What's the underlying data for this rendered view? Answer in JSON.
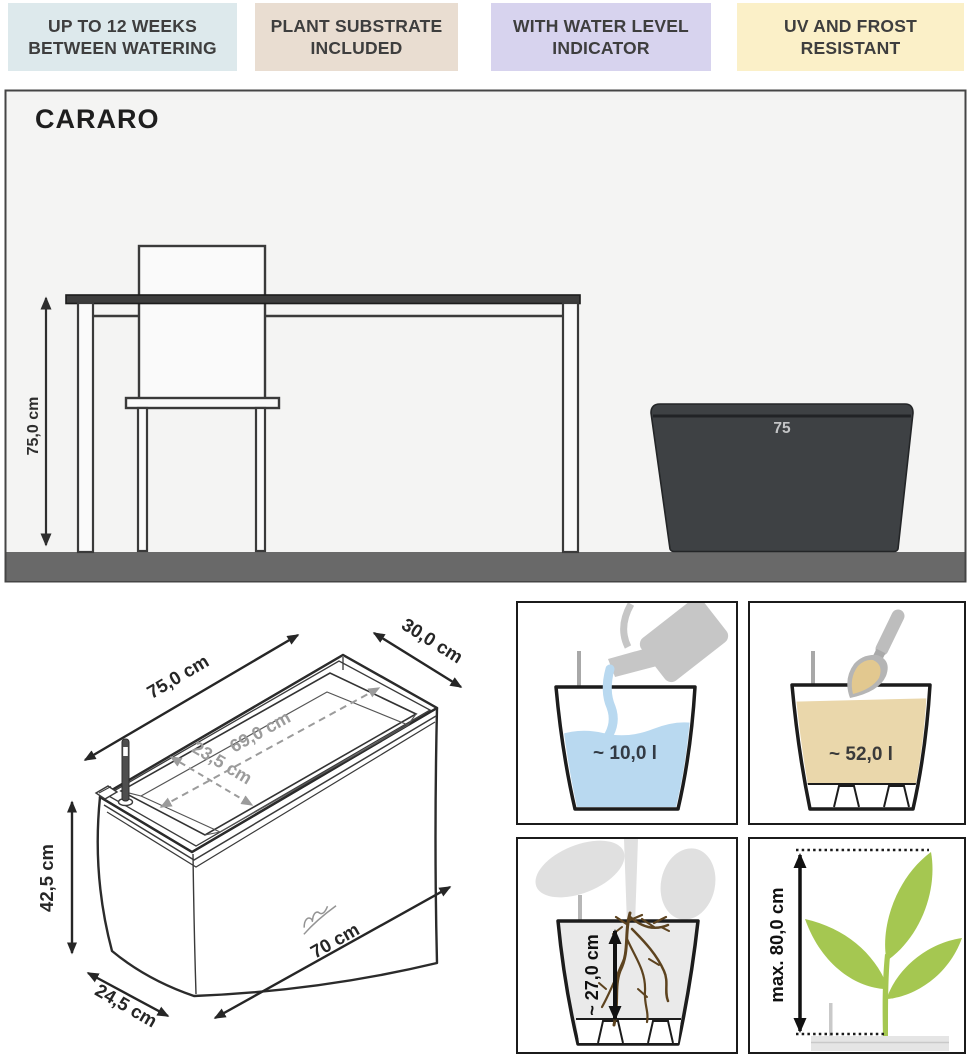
{
  "badges": [
    {
      "line1": "UP TO 12 WEEKS",
      "line2": "BETWEEN WATERING",
      "style": "background:#dde9ec"
    },
    {
      "line1": "PLANT SUBSTRATE",
      "line2": "INCLUDED",
      "style": "background:#e9ddd1"
    },
    {
      "line1": "WITH WATER LEVEL",
      "line2": "INDICATOR",
      "style": "background:#d7d3ee"
    },
    {
      "line1": "UV AND FROST",
      "line2": "RESISTANT",
      "style": "background:#fbf0c8"
    }
  ],
  "product": {
    "name": "CARARO"
  },
  "room_scene": {
    "height_dimension": "75,0 cm",
    "planter_size_label": "75"
  },
  "tech_drawing": {
    "top_length": "75,0 cm",
    "top_width": "30,0 cm",
    "inner_length": "69,0 cm",
    "inner_width": "23,5 cm",
    "height": "42,5 cm",
    "base_length": "70 cm",
    "base_width": "24,5 cm"
  },
  "feature_panels": {
    "water_volume": "~ 10,0 l",
    "substrate_volume": "~ 52,0 l",
    "root_depth": "~ 27,0 cm",
    "plant_height": "max. 80,0 cm"
  },
  "colors": {
    "water_blue": "#b9d9f0",
    "substrate_tan": "#ead7ab",
    "plant_green": "#a5c751",
    "root_brown": "#5d431f",
    "planter_dark": "#3e4144",
    "floor_gray": "#696969"
  }
}
